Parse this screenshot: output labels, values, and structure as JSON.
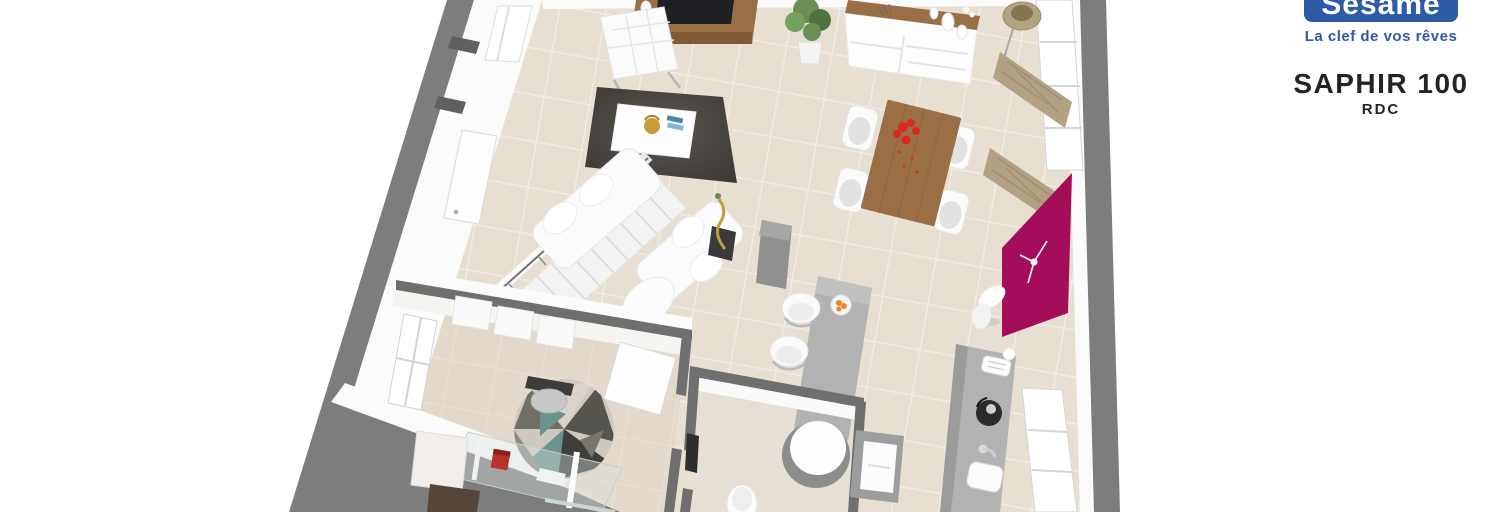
{
  "branding": {
    "logo_text": "Sésame",
    "tagline": "La clef de vos rêves"
  },
  "plan": {
    "name": "SAPHIR 100",
    "floor": "RDC"
  },
  "colors": {
    "logo_blue": "#2d5ba6",
    "title_color": "#23232b",
    "wall_gray": "#7d7d7d",
    "wall_cap": "#6f6f6f",
    "wall_white": "#fbfbfb",
    "floor_beige": "#e7dfd2",
    "floor_grout": "#f3eee5",
    "office_floor": "#ddd1c4",
    "bath_floor": "#e6dfd5",
    "rug_dark": "#3c3936",
    "rug_light": "#5a5550",
    "wood": "#9b6f45",
    "wood_dark": "#70492a",
    "magenta": "#a30d59",
    "curtain": "#b3a183",
    "plant_green": "#6a8f55",
    "plant_dark": "#4f7340",
    "flower_red": "#d92b1c",
    "teal": "#6b938c",
    "gold": "#c79a3a",
    "counter_gray": "#b2b2b2",
    "appliance_dark": "#2b2b2d",
    "chrome": "#b6b9bb"
  }
}
